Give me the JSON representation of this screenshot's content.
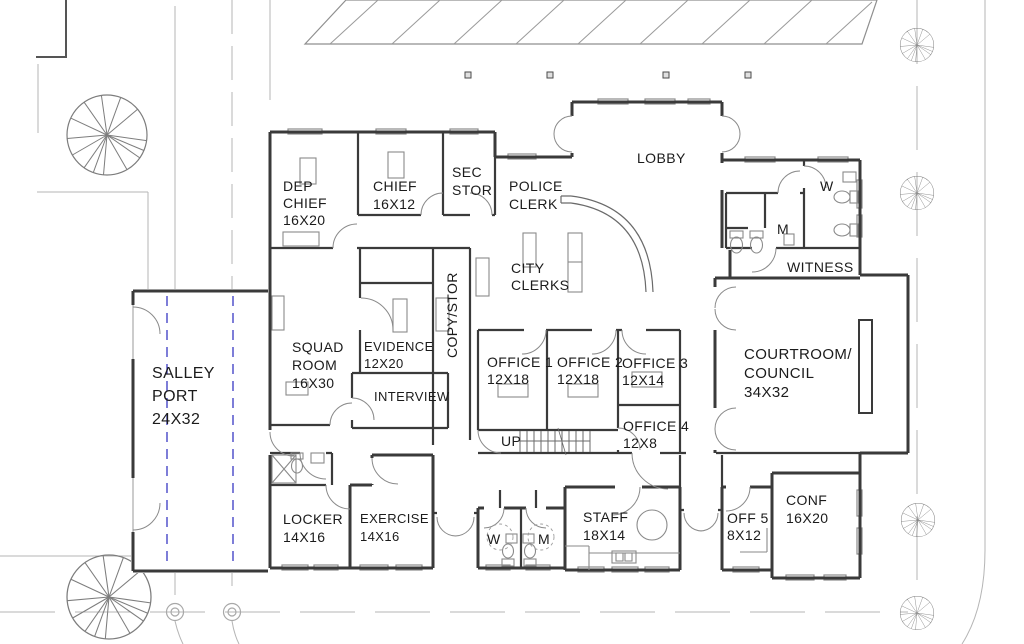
{
  "drawing_type": "architectural-floor-plan",
  "rooms": {
    "dep_chief": {
      "lines": [
        "DEP",
        "CHIEF",
        "16X20"
      ]
    },
    "chief": {
      "lines": [
        "CHIEF",
        "16X12"
      ]
    },
    "sec_stor": {
      "lines": [
        "SEC",
        "STOR"
      ]
    },
    "police_clerk": {
      "lines": [
        "POLICE",
        "CLERK"
      ]
    },
    "lobby": {
      "lines": [
        "LOBBY"
      ]
    },
    "city_clerks": {
      "lines": [
        "CITY",
        "CLERKS"
      ]
    },
    "squad_room": {
      "lines": [
        "SQUAD",
        "ROOM",
        "16X30"
      ]
    },
    "evidence": {
      "lines": [
        "EVIDENCE",
        "12X20"
      ]
    },
    "copy_stor": {
      "lines": [
        "COPY/STOR"
      ]
    },
    "interview": {
      "lines": [
        "INTERVIEW"
      ]
    },
    "salley_port": {
      "lines": [
        "SALLEY",
        "PORT",
        "24X32"
      ]
    },
    "office1": {
      "lines": [
        "OFFICE 1",
        "12X18"
      ]
    },
    "office2": {
      "lines": [
        "OFFICE 2",
        "12X18"
      ]
    },
    "office3": {
      "lines": [
        "OFFICE 3",
        "12X14"
      ]
    },
    "office4": {
      "lines": [
        "OFFICE 4",
        "12X8"
      ]
    },
    "stairs": {
      "lines": [
        "UP"
      ]
    },
    "restroom_w_top": {
      "lines": [
        "W"
      ]
    },
    "restroom_m_top": {
      "lines": [
        "M"
      ]
    },
    "witness": {
      "lines": [
        "WITNESS"
      ]
    },
    "courtroom": {
      "lines": [
        "COURTROOM/",
        "COUNCIL",
        "34X32"
      ]
    },
    "locker": {
      "lines": [
        "LOCKER",
        "14X16"
      ]
    },
    "exercise": {
      "lines": [
        "EXERCISE",
        "14X16"
      ]
    },
    "restroom_w_bottom": {
      "lines": [
        "W"
      ]
    },
    "restroom_m_bottom": {
      "lines": [
        "M"
      ]
    },
    "staff": {
      "lines": [
        "STAFF",
        "18X14"
      ]
    },
    "off5": {
      "lines": [
        "OFF 5",
        "8X12"
      ]
    },
    "conf": {
      "lines": [
        "CONF",
        "16X20"
      ]
    }
  },
  "colors": {
    "walls": "#3a3a3a",
    "doors": "#8a8a8a",
    "furniture": "#8a8a8a",
    "site_lines": "#b5b5b5",
    "overhead_door_track": "#4646c8",
    "text": "#1b1b1b"
  }
}
